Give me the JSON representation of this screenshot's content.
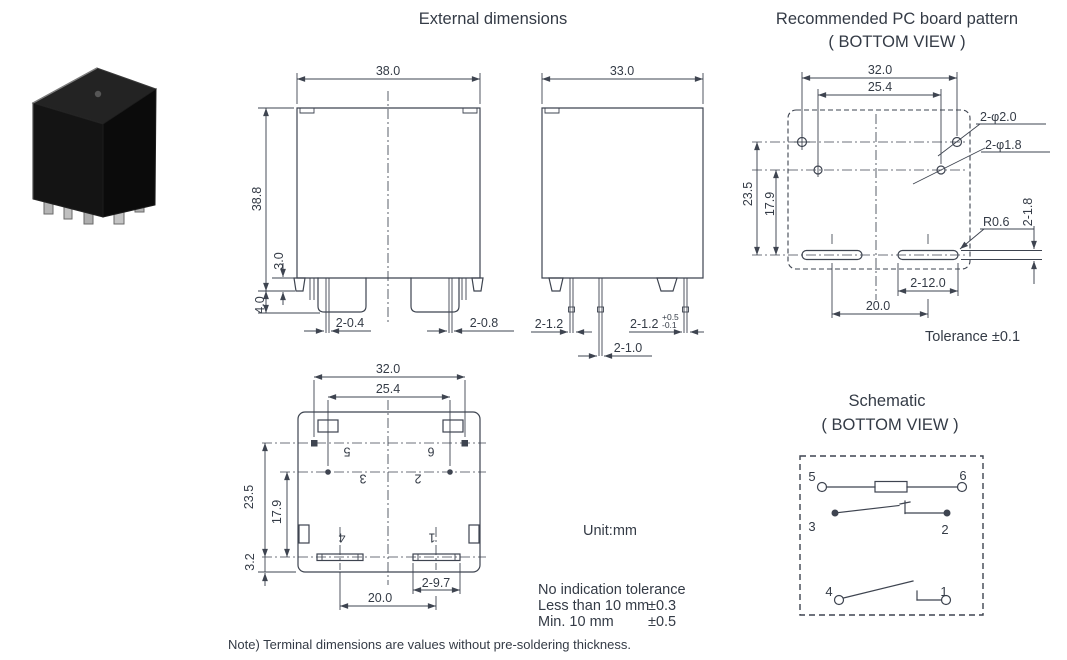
{
  "titles": {
    "external_dimensions": "External dimensions",
    "pcb_pattern": "Recommended PC board pattern",
    "pcb_pattern_sub": "( BOTTOM VIEW )",
    "schematic": "Schematic",
    "schematic_sub": "( BOTTOM VIEW )"
  },
  "notes": {
    "unit": "Unit:mm",
    "tolerance_title": "No indication tolerance",
    "tolerance_rows": [
      {
        "label": "Less than 10 mm",
        "value": "±0.3"
      },
      {
        "label": "Min. 10 mm",
        "value": "±0.5"
      }
    ],
    "pcb_tolerance": "Tolerance ±0.1",
    "footnote": "Note) Terminal dimensions are values without pre-soldering thickness."
  },
  "front_view": {
    "width": "38.0",
    "height": "38.8",
    "standoff_height": "3.0",
    "terminal_length": "4.0",
    "pin_thin": "2-0.4",
    "pin_thick": "2-0.8"
  },
  "side_view": {
    "width": "33.0",
    "pin_left": "2-1.2",
    "pin_right": "2-1.2",
    "pin_right_tol_plus": "+0.5",
    "pin_right_tol_minus": "-0.1",
    "pin_center": "2-1.0"
  },
  "bottom_view": {
    "width_outer": "32.0",
    "width_inner": "25.4",
    "height_1": "23.5",
    "height_2": "17.9",
    "height_3": "3.2",
    "slot_length": "2-9.7",
    "pitch": "20.0",
    "pins": {
      "p5": "5",
      "p6": "6",
      "p3": "3",
      "p2": "2",
      "p4": "4",
      "p1": "1"
    }
  },
  "pcb_pattern": {
    "width_outer": "32.0",
    "width_inner": "25.4",
    "height_1": "23.5",
    "height_2": "17.9",
    "hole_coil": "2-φ2.0",
    "hole_contact": "2-φ1.8",
    "slot_radius": "R0.6",
    "slot_height": "2-1.8",
    "slot_length": "2-12.0",
    "pitch": "20.0"
  },
  "schematic": {
    "pins": {
      "p5": "5",
      "p6": "6",
      "p3": "3",
      "p2": "2",
      "p4": "4",
      "p1": "1"
    }
  }
}
